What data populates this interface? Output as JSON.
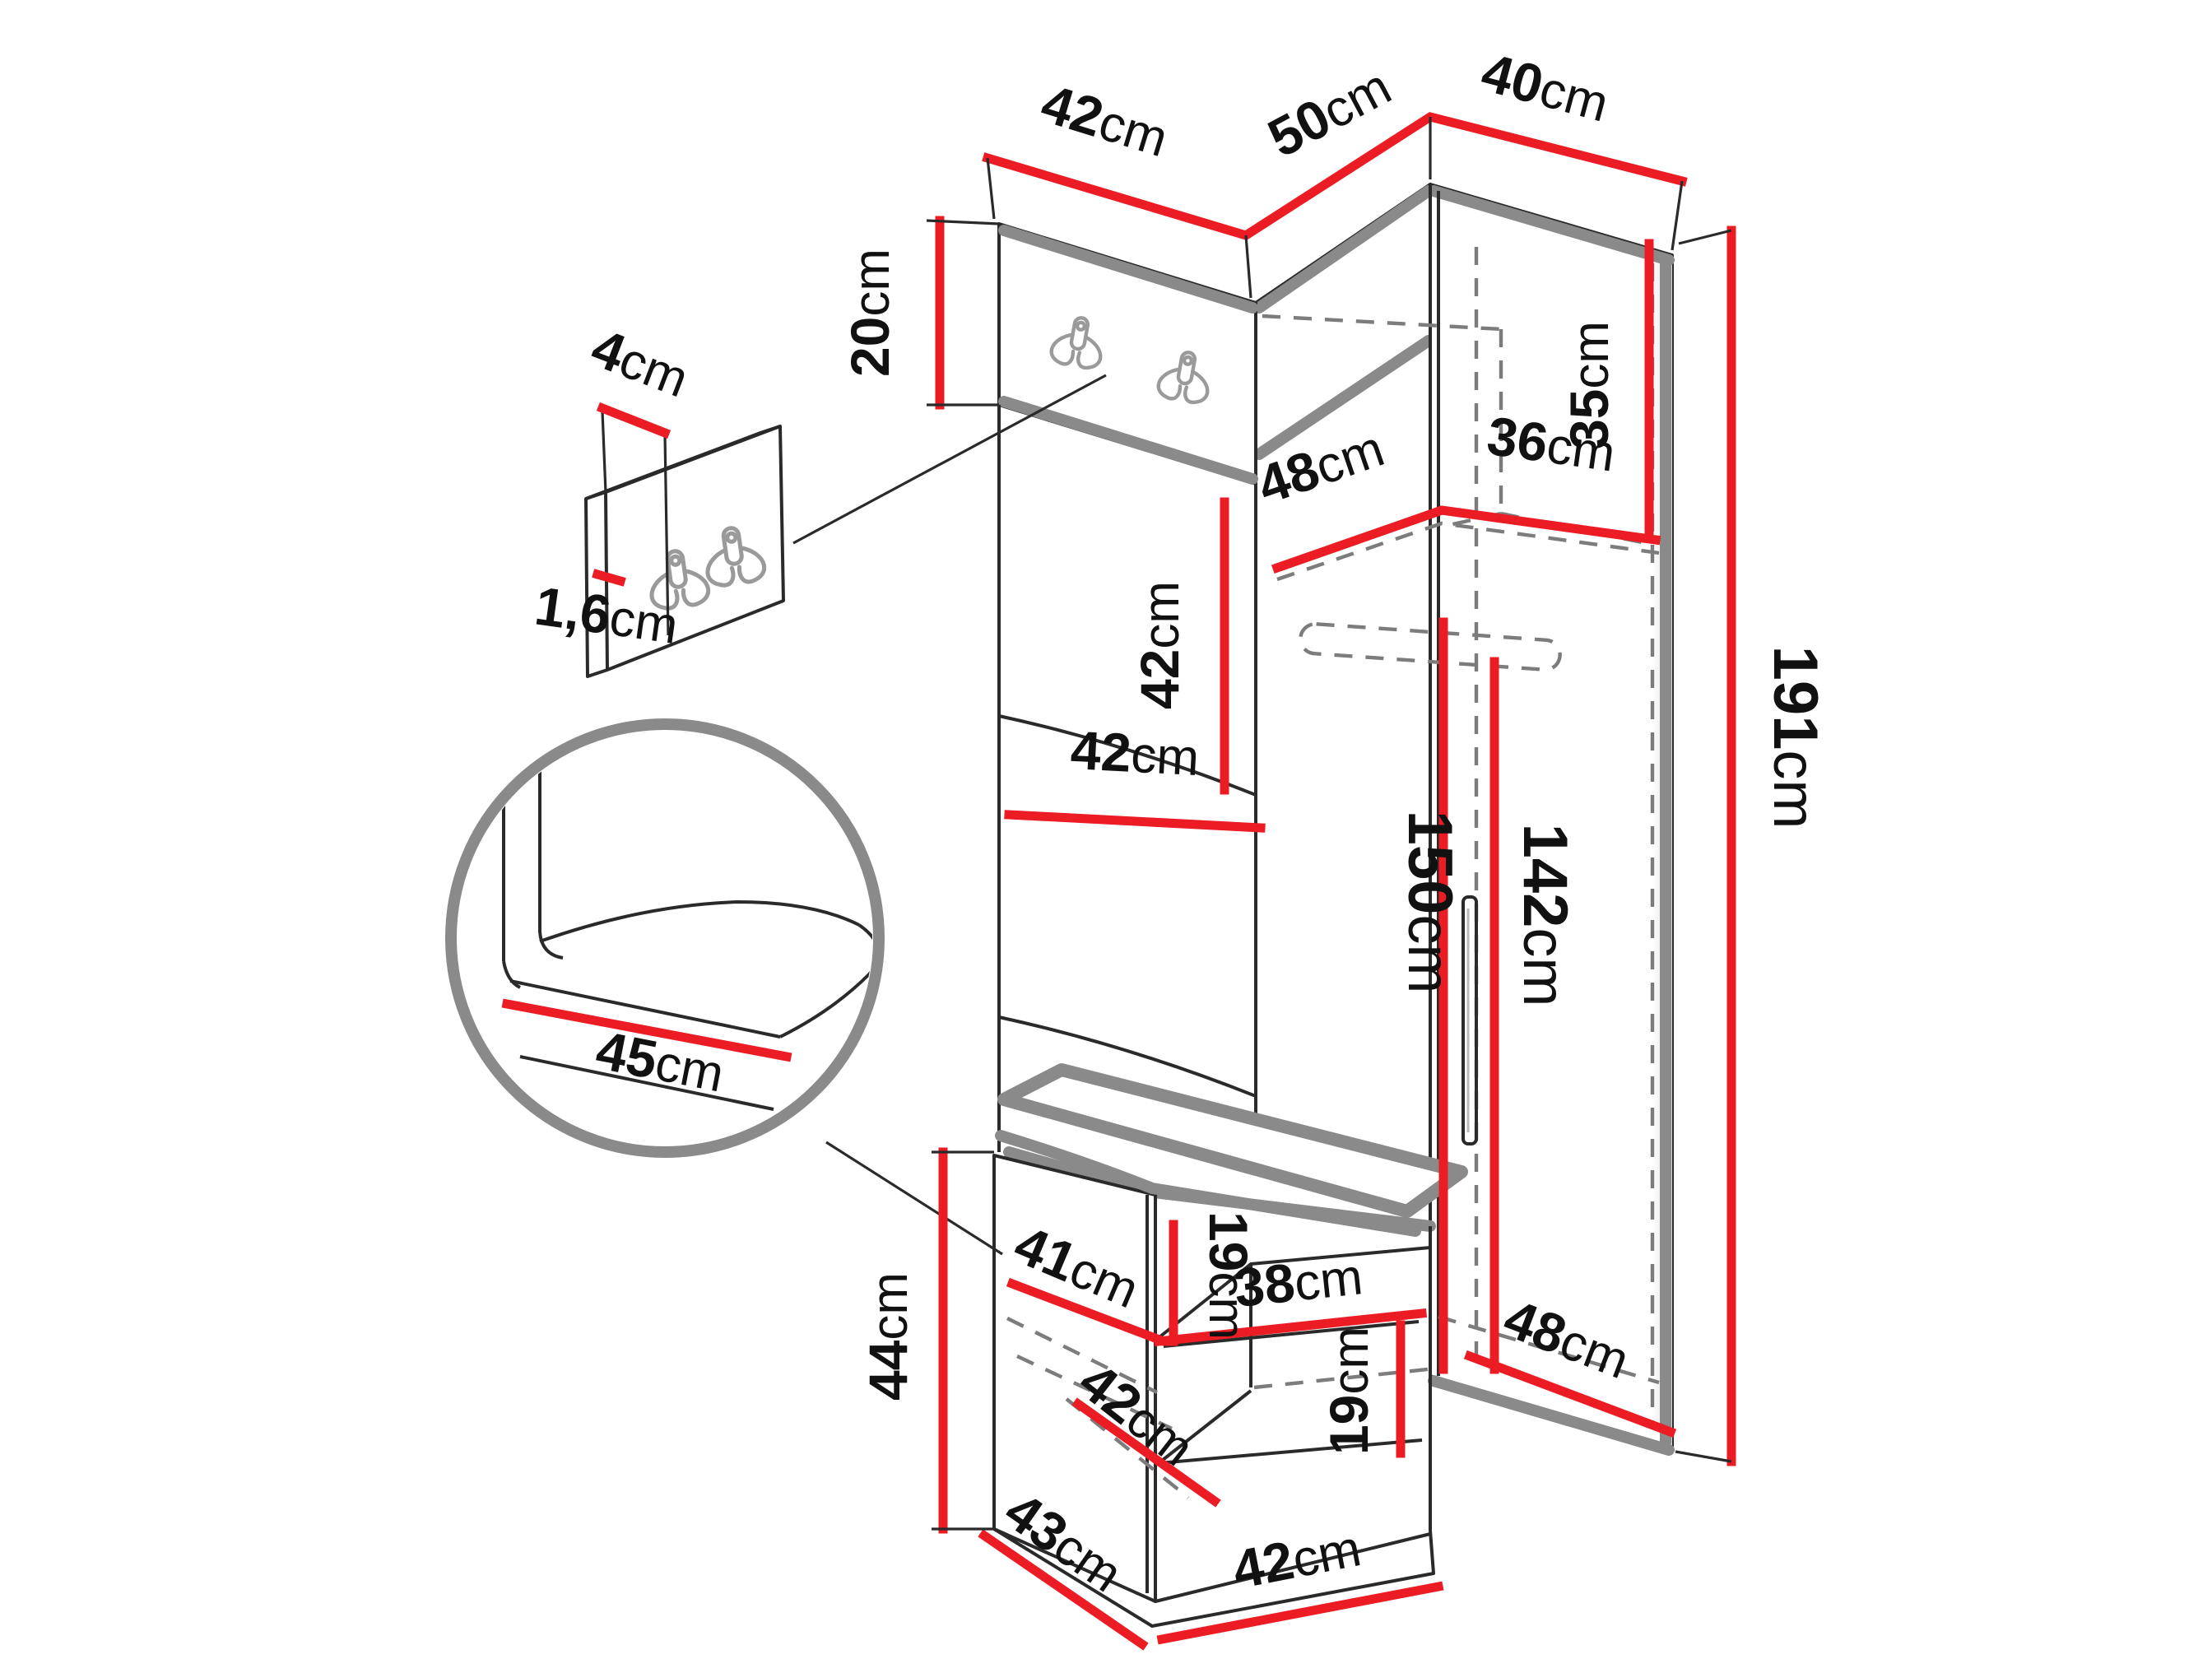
{
  "diagram": {
    "type": "furniture-dimension-diagram",
    "unit": "cm",
    "colors": {
      "background": "#ffffff",
      "dimension_line": "#ec1c24",
      "body_edge_gray": "#8a8a8a",
      "outline_black": "#2a2a2a",
      "dashed_hidden": "#7c7c7c",
      "label_text": "#111111"
    },
    "dims": {
      "top_width_left": {
        "v": "42",
        "u": "cm"
      },
      "top_width_middle": {
        "v": "50",
        "u": "cm"
      },
      "top_width_right": {
        "v": "40",
        "u": "cm"
      },
      "hook_board_height": {
        "v": "20",
        "u": "cm"
      },
      "detail_hook_spacing": {
        "v": "4",
        "u": "cm"
      },
      "detail_board_thickness": {
        "v": "1,6",
        "u": "cm"
      },
      "upper_panel_height": {
        "v": "42",
        "u": "cm"
      },
      "top_shelf_depth": {
        "v": "48",
        "u": "cm"
      },
      "top_shelf_width": {
        "v": "36",
        "u": "cm"
      },
      "top_compartment_height": {
        "v": "35",
        "u": "cm"
      },
      "panel_width": {
        "v": "42",
        "u": "cm"
      },
      "interior_height": {
        "v": "150",
        "u": "cm"
      },
      "rail_height": {
        "v": "142",
        "u": "cm"
      },
      "total_height": {
        "v": "191",
        "u": "cm"
      },
      "seat_depth_detail": {
        "v": "45",
        "u": "cm"
      },
      "bench_height": {
        "v": "44",
        "u": "cm"
      },
      "bench_shelf_width": {
        "v": "41",
        "u": "cm"
      },
      "bench_upper_gap": {
        "v": "19",
        "u": "cm"
      },
      "bench_shelf_depth": {
        "v": "38",
        "u": "cm"
      },
      "bench_lower_gap": {
        "v": "19",
        "u": "cm"
      },
      "bench_floor_depth": {
        "v": "42",
        "u": "cm"
      },
      "base_side_depth": {
        "v": "43",
        "u": "cm"
      },
      "base_front_width": {
        "v": "42",
        "u": "cm"
      },
      "wardrobe_floor_depth": {
        "v": "48",
        "u": "cm"
      }
    }
  }
}
